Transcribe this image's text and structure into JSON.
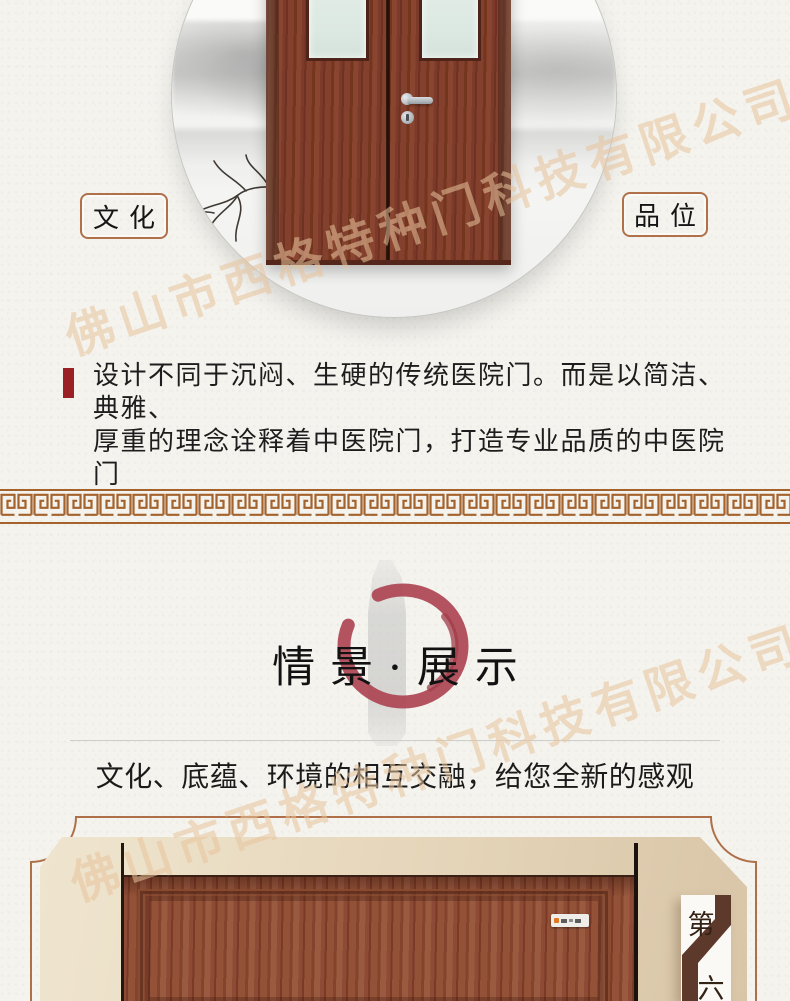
{
  "watermark": {
    "text": "佛山市西格特种门科技有限公司",
    "color": "#e8c49c"
  },
  "hero": {
    "culture_tag": "文化",
    "taste_tag": "品位",
    "intro": "设计不同于沉闷、生硬的传统医院门。而是以简洁、典雅、\n厚重的理念诠释着中医院门，打造专业品质的中医院门"
  },
  "display": {
    "title": "情景·展示",
    "subtitle": "文化、底蕴、环境的相互交融，给您全新的感观",
    "page_marker": {
      "top_char": "第",
      "bottom_char": "六"
    }
  },
  "colors": {
    "accent_brown": "#a4622c",
    "frame_brown": "#ae6f49",
    "accent_red": "#9b2026",
    "enso_red": "#ac4150",
    "ribbon_brown": "#5d392b",
    "paper": "#f4f3ee"
  }
}
